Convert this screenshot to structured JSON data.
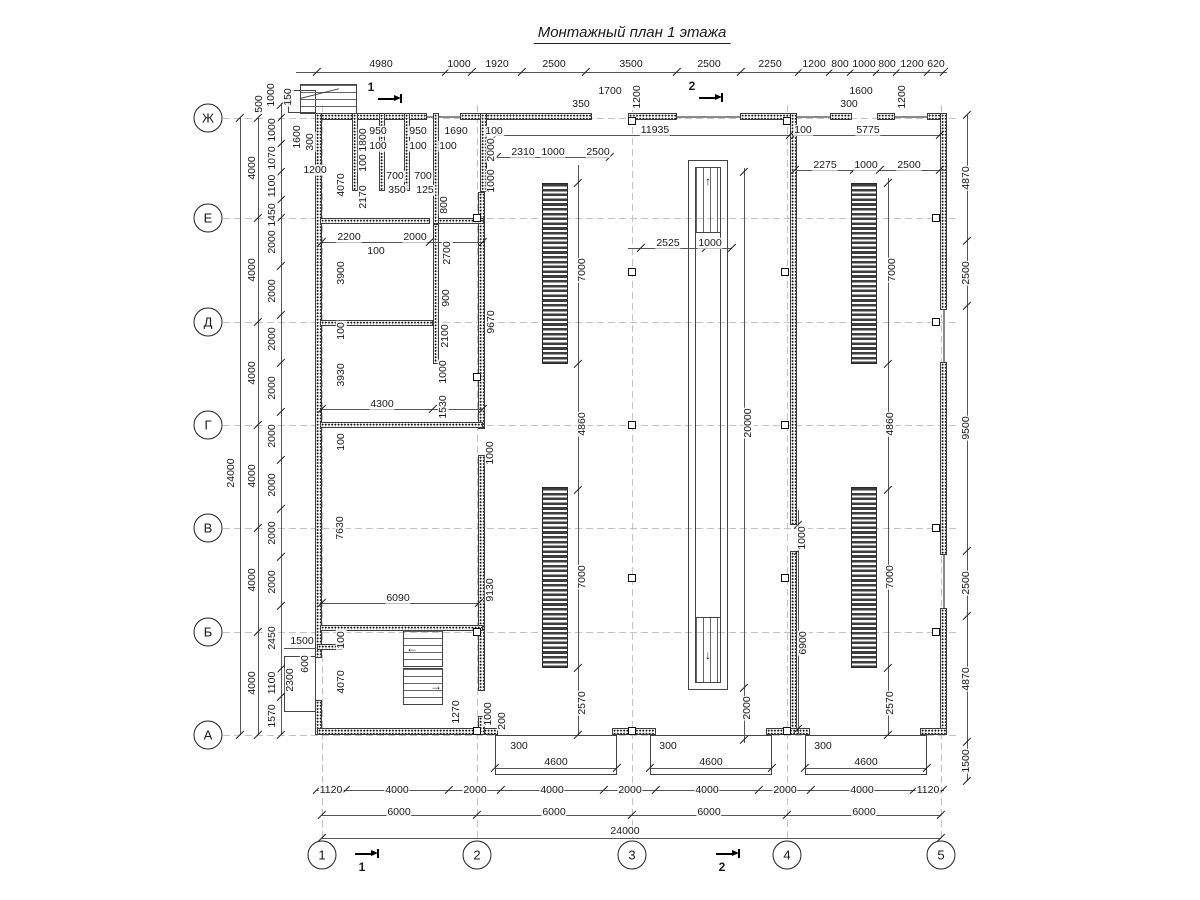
{
  "title": "Монтажный план 1 этажа",
  "grid": {
    "row_labels": [
      "Ж",
      "Е",
      "Д",
      "Г",
      "В",
      "Б",
      "А"
    ],
    "col_labels": [
      "1",
      "2",
      "3",
      "4",
      "5"
    ]
  },
  "section_marks": [
    {
      "label": "1",
      "lx": 371,
      "ly": 87,
      "ax": 378,
      "ay": 98
    },
    {
      "label": "1",
      "lx": 362,
      "ly": 867,
      "ax": 355,
      "ay": 853
    },
    {
      "label": "2",
      "lx": 692,
      "ly": 86,
      "ax": 699,
      "ay": 97
    },
    {
      "label": "2",
      "lx": 722,
      "ly": 867,
      "ax": 716,
      "ay": 853
    }
  ],
  "colors": {
    "ink": "#1a1a1a",
    "wall": "#3c3c3c",
    "equipment": "#3d3d3d",
    "axis": "#c4c4c4"
  },
  "dim_labels": [
    {
      "t": "4980",
      "x": 381,
      "y": 64,
      "r": 0
    },
    {
      "t": "1000",
      "x": 459,
      "y": 64,
      "r": 0
    },
    {
      "t": "1920",
      "x": 497,
      "y": 64,
      "r": 0
    },
    {
      "t": "2500",
      "x": 554,
      "y": 64,
      "r": 0
    },
    {
      "t": "3500",
      "x": 631,
      "y": 64,
      "r": 0
    },
    {
      "t": "2500",
      "x": 709,
      "y": 64,
      "r": 0
    },
    {
      "t": "2250",
      "x": 770,
      "y": 64,
      "r": 0
    },
    {
      "t": "1200",
      "x": 814,
      "y": 64,
      "r": 0
    },
    {
      "t": "800",
      "x": 840,
      "y": 64,
      "r": 0
    },
    {
      "t": "1000",
      "x": 864,
      "y": 64,
      "r": 0
    },
    {
      "t": "800",
      "x": 887,
      "y": 64,
      "r": 0
    },
    {
      "t": "1200",
      "x": 912,
      "y": 64,
      "r": 0
    },
    {
      "t": "620",
      "x": 936,
      "y": 64,
      "r": 0
    },
    {
      "t": "1700",
      "x": 610,
      "y": 91,
      "r": 0
    },
    {
      "t": "350",
      "x": 581,
      "y": 104,
      "r": 0
    },
    {
      "t": "1200",
      "x": 637,
      "y": 97,
      "r": 90
    },
    {
      "t": "1600",
      "x": 861,
      "y": 91,
      "r": 0
    },
    {
      "t": "300",
      "x": 849,
      "y": 104,
      "r": 0
    },
    {
      "t": "1200",
      "x": 902,
      "y": 97,
      "r": 90
    },
    {
      "t": "950",
      "x": 378,
      "y": 131,
      "r": 0
    },
    {
      "t": "950",
      "x": 418,
      "y": 131,
      "r": 0
    },
    {
      "t": "1690",
      "x": 456,
      "y": 131,
      "r": 0
    },
    {
      "t": "100",
      "x": 494,
      "y": 131,
      "r": 0
    },
    {
      "t": "11935",
      "x": 655,
      "y": 130,
      "r": 0
    },
    {
      "t": "100",
      "x": 803,
      "y": 130,
      "r": 0
    },
    {
      "t": "5775",
      "x": 868,
      "y": 130,
      "r": 0
    },
    {
      "t": "100",
      "x": 378,
      "y": 146,
      "r": 0
    },
    {
      "t": "100",
      "x": 418,
      "y": 146,
      "r": 0
    },
    {
      "t": "100",
      "x": 448,
      "y": 146,
      "r": 0
    },
    {
      "t": "2310",
      "x": 523,
      "y": 152,
      "r": 0
    },
    {
      "t": "1000",
      "x": 553,
      "y": 152,
      "r": 0
    },
    {
      "t": "2500",
      "x": 598,
      "y": 152,
      "r": 0
    },
    {
      "t": "2275",
      "x": 825,
      "y": 165,
      "r": 0
    },
    {
      "t": "1000",
      "x": 866,
      "y": 165,
      "r": 0
    },
    {
      "t": "2500",
      "x": 909,
      "y": 165,
      "r": 0
    },
    {
      "t": "24000",
      "x": 231,
      "y": 473,
      "r": 90
    },
    {
      "t": "4000",
      "x": 252,
      "y": 168,
      "r": 90
    },
    {
      "t": "4000",
      "x": 252,
      "y": 270,
      "r": 90
    },
    {
      "t": "4000",
      "x": 252,
      "y": 373,
      "r": 90
    },
    {
      "t": "4000",
      "x": 252,
      "y": 476,
      "r": 90
    },
    {
      "t": "4000",
      "x": 252,
      "y": 580,
      "r": 90
    },
    {
      "t": "4000",
      "x": 252,
      "y": 683,
      "r": 90
    },
    {
      "t": "1000",
      "x": 272,
      "y": 130,
      "r": 90
    },
    {
      "t": "1070",
      "x": 272,
      "y": 158,
      "r": 90
    },
    {
      "t": "1100",
      "x": 272,
      "y": 186,
      "r": 90
    },
    {
      "t": "1450",
      "x": 272,
      "y": 215,
      "r": 90
    },
    {
      "t": "2000",
      "x": 272,
      "y": 242,
      "r": 90
    },
    {
      "t": "2000",
      "x": 272,
      "y": 291,
      "r": 90
    },
    {
      "t": "2000",
      "x": 272,
      "y": 339,
      "r": 90
    },
    {
      "t": "2000",
      "x": 272,
      "y": 388,
      "r": 90
    },
    {
      "t": "2000",
      "x": 272,
      "y": 436,
      "r": 90
    },
    {
      "t": "2000",
      "x": 272,
      "y": 485,
      "r": 90
    },
    {
      "t": "2000",
      "x": 272,
      "y": 533,
      "r": 90
    },
    {
      "t": "2000",
      "x": 272,
      "y": 582,
      "r": 90
    },
    {
      "t": "2450",
      "x": 272,
      "y": 638,
      "r": 90
    },
    {
      "t": "1100",
      "x": 272,
      "y": 683,
      "r": 90
    },
    {
      "t": "1570",
      "x": 272,
      "y": 716,
      "r": 90
    },
    {
      "t": "500",
      "x": 259,
      "y": 104,
      "r": 90
    },
    {
      "t": "1000",
      "x": 271,
      "y": 95,
      "r": 90
    },
    {
      "t": "150",
      "x": 288,
      "y": 97,
      "r": 90
    },
    {
      "t": "1600",
      "x": 297,
      "y": 137,
      "r": 90
    },
    {
      "t": "300",
      "x": 310,
      "y": 142,
      "r": 90
    },
    {
      "t": "1200",
      "x": 315,
      "y": 170,
      "r": 0
    },
    {
      "t": "4070",
      "x": 341,
      "y": 185,
      "r": 90
    },
    {
      "t": "1800",
      "x": 363,
      "y": 140,
      "r": 90
    },
    {
      "t": "100",
      "x": 363,
      "y": 163,
      "r": 90
    },
    {
      "t": "2170",
      "x": 363,
      "y": 197,
      "r": 90
    },
    {
      "t": "700",
      "x": 395,
      "y": 176,
      "r": 0
    },
    {
      "t": "700",
      "x": 423,
      "y": 176,
      "r": 0
    },
    {
      "t": "350",
      "x": 397,
      "y": 190,
      "r": 0
    },
    {
      "t": "125",
      "x": 425,
      "y": 190,
      "r": 0
    },
    {
      "t": "800",
      "x": 444,
      "y": 205,
      "r": 90
    },
    {
      "t": "2700",
      "x": 447,
      "y": 253,
      "r": 90
    },
    {
      "t": "900",
      "x": 446,
      "y": 298,
      "r": 90
    },
    {
      "t": "2000",
      "x": 491,
      "y": 150,
      "r": 90
    },
    {
      "t": "1000",
      "x": 491,
      "y": 181,
      "r": 90
    },
    {
      "t": "9670",
      "x": 491,
      "y": 322,
      "r": 90
    },
    {
      "t": "2200",
      "x": 349,
      "y": 237,
      "r": 0
    },
    {
      "t": "2000",
      "x": 415,
      "y": 237,
      "r": 0
    },
    {
      "t": "100",
      "x": 376,
      "y": 251,
      "r": 0
    },
    {
      "t": "3900",
      "x": 341,
      "y": 273,
      "r": 90
    },
    {
      "t": "100",
      "x": 341,
      "y": 331,
      "r": 90
    },
    {
      "t": "2100",
      "x": 445,
      "y": 336,
      "r": 90
    },
    {
      "t": "1000",
      "x": 443,
      "y": 372,
      "r": 90
    },
    {
      "t": "1530",
      "x": 443,
      "y": 407,
      "r": 90
    },
    {
      "t": "3930",
      "x": 341,
      "y": 375,
      "r": 90
    },
    {
      "t": "4300",
      "x": 382,
      "y": 404,
      "r": 0
    },
    {
      "t": "100",
      "x": 341,
      "y": 442,
      "r": 90
    },
    {
      "t": "1000",
      "x": 490,
      "y": 453,
      "r": 90
    },
    {
      "t": "7630",
      "x": 340,
      "y": 528,
      "r": 90
    },
    {
      "t": "6090",
      "x": 398,
      "y": 598,
      "r": 0
    },
    {
      "t": "9130",
      "x": 490,
      "y": 590,
      "r": 90
    },
    {
      "t": "100",
      "x": 341,
      "y": 640,
      "r": 90
    },
    {
      "t": "4070",
      "x": 341,
      "y": 682,
      "r": 90
    },
    {
      "t": "1500",
      "x": 302,
      "y": 641,
      "r": 0
    },
    {
      "t": "600",
      "x": 305,
      "y": 664,
      "r": 90
    },
    {
      "t": "2300",
      "x": 290,
      "y": 680,
      "r": 90
    },
    {
      "t": "1270",
      "x": 456,
      "y": 712,
      "r": 90
    },
    {
      "t": "1000",
      "x": 488,
      "y": 714,
      "r": 90
    },
    {
      "t": "200",
      "x": 502,
      "y": 721,
      "r": 90
    },
    {
      "t": "7000",
      "x": 582,
      "y": 270,
      "r": 90
    },
    {
      "t": "4860",
      "x": 582,
      "y": 424,
      "r": 90
    },
    {
      "t": "7000",
      "x": 582,
      "y": 577,
      "r": 90
    },
    {
      "t": "2570",
      "x": 582,
      "y": 703,
      "r": 90
    },
    {
      "t": "2525",
      "x": 668,
      "y": 243,
      "r": 0
    },
    {
      "t": "1000",
      "x": 710,
      "y": 243,
      "r": 0
    },
    {
      "t": "20000",
      "x": 748,
      "y": 423,
      "r": 90
    },
    {
      "t": "2000",
      "x": 747,
      "y": 708,
      "r": 90
    },
    {
      "t": "1000",
      "x": 802,
      "y": 538,
      "r": 90
    },
    {
      "t": "6900",
      "x": 803,
      "y": 643,
      "r": 90
    },
    {
      "t": "7000",
      "x": 892,
      "y": 270,
      "r": 90
    },
    {
      "t": "4860",
      "x": 890,
      "y": 424,
      "r": 90
    },
    {
      "t": "7000",
      "x": 890,
      "y": 577,
      "r": 90
    },
    {
      "t": "2570",
      "x": 890,
      "y": 703,
      "r": 90
    },
    {
      "t": "300",
      "x": 519,
      "y": 746,
      "r": 0
    },
    {
      "t": "300",
      "x": 668,
      "y": 746,
      "r": 0
    },
    {
      "t": "300",
      "x": 823,
      "y": 746,
      "r": 0
    },
    {
      "t": "4600",
      "x": 556,
      "y": 762,
      "r": 0
    },
    {
      "t": "4600",
      "x": 711,
      "y": 762,
      "r": 0
    },
    {
      "t": "4600",
      "x": 866,
      "y": 762,
      "r": 0
    },
    {
      "t": "1120",
      "x": 331,
      "y": 790,
      "r": 0
    },
    {
      "t": "4000",
      "x": 397,
      "y": 790,
      "r": 0
    },
    {
      "t": "2000",
      "x": 475,
      "y": 790,
      "r": 0
    },
    {
      "t": "4000",
      "x": 552,
      "y": 790,
      "r": 0
    },
    {
      "t": "2000",
      "x": 630,
      "y": 790,
      "r": 0
    },
    {
      "t": "4000",
      "x": 707,
      "y": 790,
      "r": 0
    },
    {
      "t": "2000",
      "x": 785,
      "y": 790,
      "r": 0
    },
    {
      "t": "4000",
      "x": 862,
      "y": 790,
      "r": 0
    },
    {
      "t": "1120",
      "x": 928,
      "y": 790,
      "r": 0
    },
    {
      "t": "6000",
      "x": 399,
      "y": 812,
      "r": 0
    },
    {
      "t": "6000",
      "x": 554,
      "y": 812,
      "r": 0
    },
    {
      "t": "6000",
      "x": 709,
      "y": 812,
      "r": 0
    },
    {
      "t": "6000",
      "x": 864,
      "y": 812,
      "r": 0
    },
    {
      "t": "24000",
      "x": 625,
      "y": 831,
      "r": 0
    },
    {
      "t": "4870",
      "x": 966,
      "y": 178,
      "r": 90
    },
    {
      "t": "2500",
      "x": 966,
      "y": 273,
      "r": 90
    },
    {
      "t": "9500",
      "x": 966,
      "y": 428,
      "r": 90
    },
    {
      "t": "2500",
      "x": 966,
      "y": 583,
      "r": 90
    },
    {
      "t": "4870",
      "x": 966,
      "y": 679,
      "r": 90
    },
    {
      "t": "1500",
      "x": 966,
      "y": 761,
      "r": 90
    }
  ]
}
